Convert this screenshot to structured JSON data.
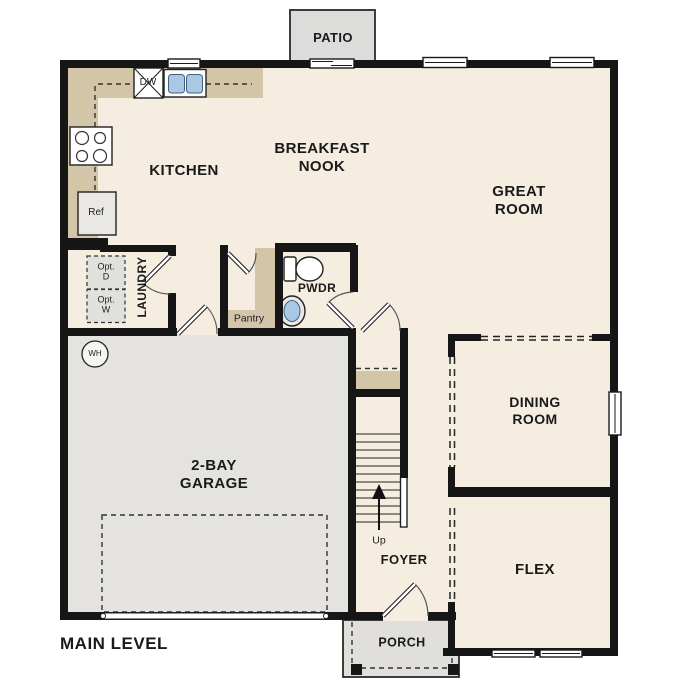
{
  "title": "MAIN LEVEL",
  "colors": {
    "floor": "#f5eee0",
    "counter": "#d3c5a8",
    "garage": "#e4e3e0",
    "patio": "#dcdcda",
    "porch": "#e0dfdc",
    "optbox": "#e0e1dc",
    "blue": "#a9c8e6",
    "wall": "#161616"
  },
  "rooms": {
    "kitchen": {
      "label": "KITCHEN"
    },
    "breakfast_nook": {
      "label": "BREAKFAST\nNOOK"
    },
    "great_room": {
      "label": "GREAT\nROOM"
    },
    "dining_room": {
      "label": "DINING\nROOM"
    },
    "flex": {
      "label": "FLEX"
    },
    "foyer": {
      "label": "FOYER"
    },
    "garage": {
      "label": "2-BAY\nGARAGE"
    },
    "powder": {
      "label": "PWDR"
    },
    "laundry": {
      "label": "LAUNDRY"
    },
    "pantry": {
      "label": "Pantry"
    },
    "patio": {
      "label": "PATIO"
    },
    "porch": {
      "label": "PORCH"
    }
  },
  "fixtures": {
    "dishwasher": "DW",
    "refrigerator": "Ref",
    "water_heater": "WH",
    "stairs_direction": "Up",
    "optional_dryer": "Opt.\nD",
    "optional_washer": "Opt.\nW"
  }
}
